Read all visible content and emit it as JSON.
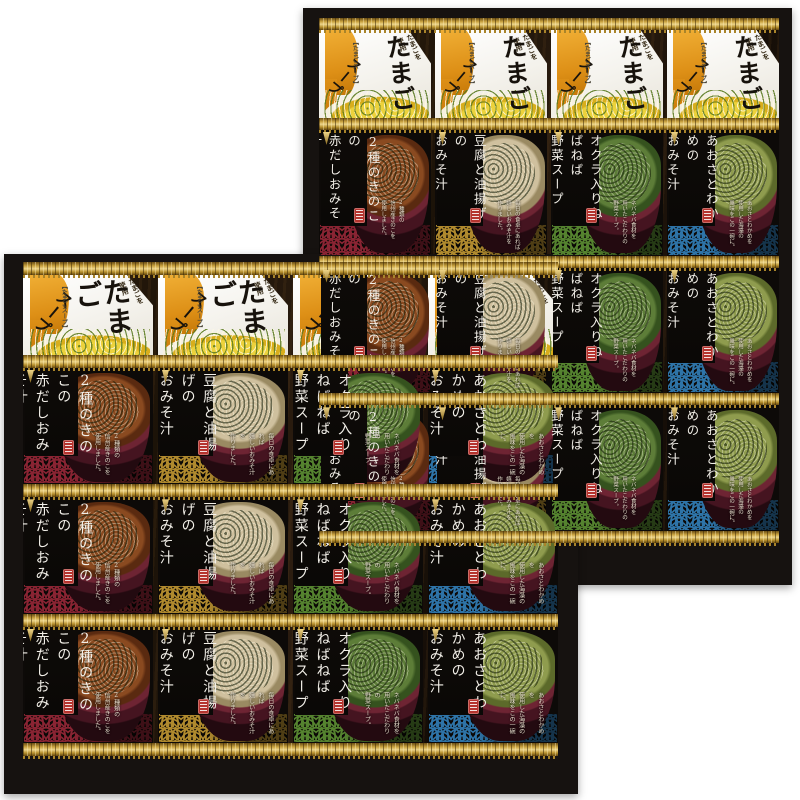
{
  "product": {
    "tamago": {
      "corner_note": "国産の\nたまごを\n使用",
      "title": "たまご",
      "subtitle": "スープ",
      "bracket_label": "【たまごスープ】"
    },
    "miso_varieties": [
      {
        "key": "akadashi-kinoko",
        "name": "2種のきのこの\n赤だしおみそ汁",
        "desc": "2種類の\n信州産きのこを\n使用しました。",
        "wave_color": "#8a2433",
        "soup_color": "#8a4a20",
        "soup_deep": "#5a2a10"
      },
      {
        "key": "tofu-aburaage",
        "name": "豆腐と油揚げの\nおみそ汁",
        "desc": "毎日の食卓にあれば\n嬉しいおみそ汁を\n作りました。",
        "wave_color": "#b08a2e",
        "soup_color": "#cfc09e",
        "soup_deep": "#9a8a62"
      },
      {
        "key": "okra-nebaneba-yasai",
        "name": "オクラ入りねばねば\n野菜スープ",
        "desc": "ネバネバ食材を\n用いたこだわりの\n野菜スープ。",
        "wave_color": "#55832f",
        "soup_color": "#5d7d38",
        "soup_deep": "#35521e"
      },
      {
        "key": "aosa-wakame",
        "name": "あおさとわかめの\nおみそ汁",
        "desc": "あおさとわかめを\n使用した海藻の\n風味をこの一碗に。",
        "wave_color": "#2e74a8",
        "soup_color": "#8f9c4e",
        "soup_deep": "#5c6a2a"
      }
    ],
    "colors": {
      "box_frame": "#161210",
      "box_interior_wood": "#2c1d10",
      "gold_trim": "#c9a23f",
      "tamago_accent": "#dd8f16",
      "bowl_red": "#5e1d2a",
      "label_black": "#0b0907",
      "seal_red": "#b5342e"
    }
  }
}
